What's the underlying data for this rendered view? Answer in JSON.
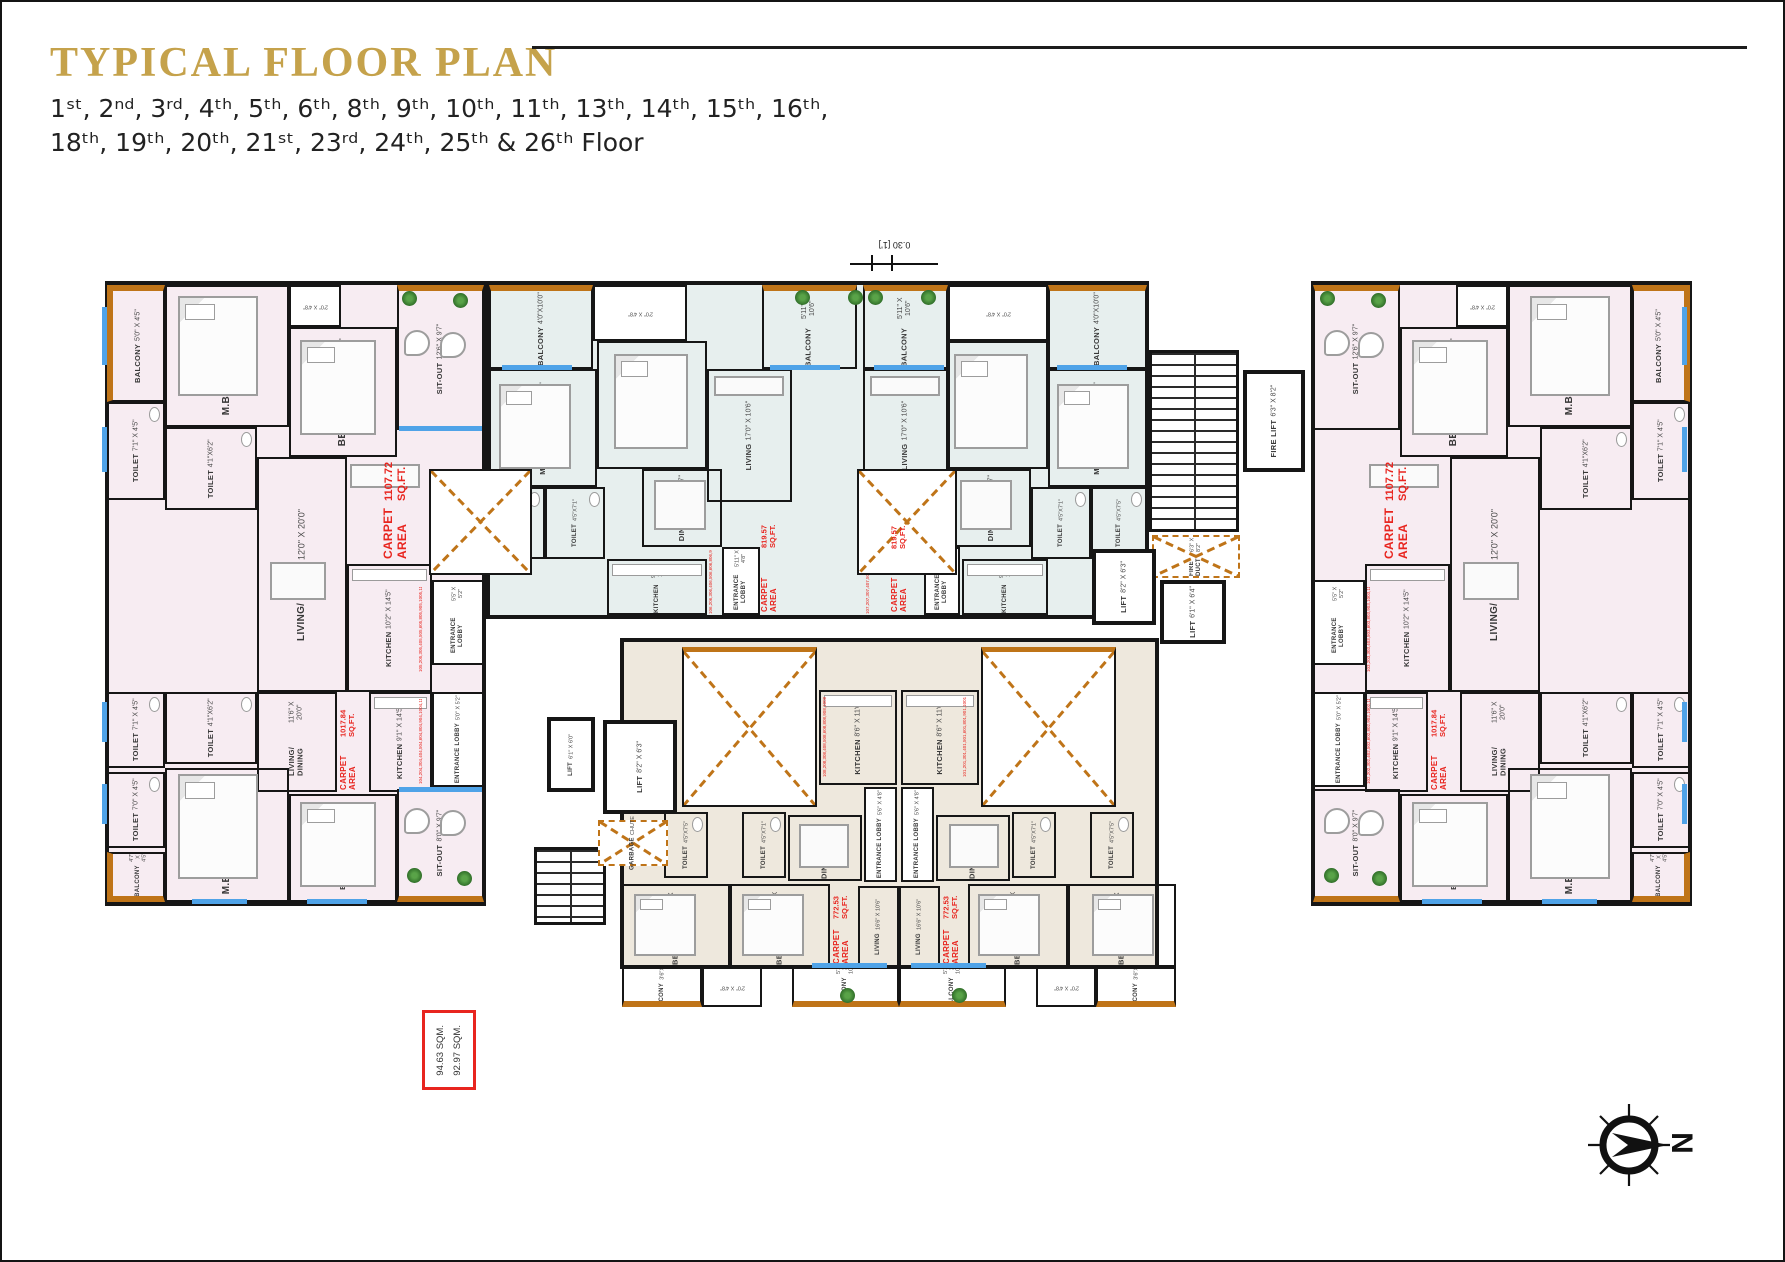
{
  "header": {
    "title": "TYPICAL FLOOR PLAN",
    "floors_line1": "1ˢᵗ, 2ⁿᵈ, 3ʳᵈ, 4ᵗʰ, 5ᵗʰ, 6ᵗʰ, 8ᵗʰ, 9ᵗʰ, 10ᵗʰ, 11ᵗʰ, 13ᵗʰ, 14ᵗʰ, 15ᵗʰ, 16ᵗʰ,",
    "floors_line2": "18ᵗʰ, 19ᵗʰ, 20ᵗʰ, 21ˢᵗ, 23ʳᵈ, 24ᵗʰ, 25ᵗʰ & 26ᵗʰ Floor"
  },
  "colors": {
    "gold": "#c5a24b",
    "carpet_red": "#e8251f",
    "balcony_orange": "#bf7418",
    "window_blue": "#4fa3e8",
    "wing_pink": "#f7ecf2",
    "center_teal": "#e7efee",
    "lower_tan": "#eee8dd"
  },
  "legend": {
    "area1": "94.63 SQM.",
    "area2": "92.97 SQM."
  },
  "compass": {
    "north": "N"
  },
  "dim_note": "0.30 [1']",
  "units": {
    "c1107": {
      "l1": "CARPET AREA",
      "l2": "1107.72 SQ.FT."
    },
    "c1017": {
      "l1": "CARPET AREA",
      "l2": "1017.84 SQ.FT."
    },
    "c819": {
      "l1": "CARPET AREA",
      "l2": "819.57 SQ.FT."
    },
    "c772": {
      "l1": "CARPET AREA",
      "l2": "772.53 SQ.FT."
    }
  },
  "flats": {
    "f05": "105,205,305,405,505,605,805,905,1005,1105,1305,1405,1505,1605,1805,1905,2005,2105,2305,2405,2505,2605",
    "f06": "106,206,306,406,506,606,806,906,1006,1106,1306,1406,1506,1606,1806,1906,2006,2106,2306,2406,2506,2606",
    "f07": "107,207,307,407,507,607,807,907,1007,1107,1307,1407,1507,1607,1807,1907,2007,2107,2307,2407,2507,2607",
    "f03": "103,203,303,403,503,603,803,903,1003,1103,1303,1403,1503,1603,1803,1903,2003,2103,2303,2403,2503,2603",
    "f04": "104,204,304,404,504,604,804,904,1004,1104,1304,1404,1504,1604,1804,1904,2004,2104,2304,2404,2504,2604",
    "f08": "108,208,308,408,508,608,808,908,1008,1108,1308,1408,1508,1608,1808,1908,2008,2108,2308,2408,2508,2608",
    "f01": "101,201,301,401,501,601,801,901,1001,1101,1301,1401,1501,1601,1801,1901,2001,2101,2301,2401,2501,2601",
    "f02": "102,202,302,402,502,602,802,902,1002,1102,1302,1402,1502,1602,1802,1902,2002,2102,2302,2402,2502,2602"
  },
  "rooms": {
    "balcony_5045": {
      "n": "BALCONY",
      "d": "5'0\" X 4'5\""
    },
    "toilet_7145": {
      "n": "TOILET",
      "d": "7'1\" X 4'5\""
    },
    "mbed_126110": {
      "n": "M.BEDROOM",
      "d": "12'6\" X 11'0\""
    },
    "duct_2048": {
      "d": "2'0\" X 4'8\""
    },
    "bed_106100": {
      "n": "BEDROOM",
      "d": "10'6\" X 10'0\""
    },
    "sitout_12697": {
      "n": "SIT-OUT",
      "d": "12'6\" X 9'7\""
    },
    "toilet_4162": {
      "n": "TOILET",
      "d": "4'1\"X6'2\""
    },
    "living_120200": {
      "n": "LIVING/ DINING",
      "d": "12'0\" X 20'0\""
    },
    "kitchen_102145": {
      "n": "KITCHEN",
      "d": "10'2\" X 14'5\""
    },
    "entrance_5552": {
      "n": "ENTRANCE LOBBY",
      "d": "5'5\" X 5'2\""
    },
    "toilet_7045": {
      "n": "TOILET",
      "d": "7'0\" X 4'5\""
    },
    "balcony_4745": {
      "n": "BALCONY",
      "d": "4'7\" X 4'5\""
    },
    "living_116200": {
      "n": "LIVING/ DINING",
      "d": "11'6\" X 20'0\""
    },
    "kitchen_91145": {
      "n": "KITCHEN",
      "d": "9'1\" X 14'5\""
    },
    "entrance_5052": {
      "n": "ENTRANCE LOBBY",
      "d": "5'0\" X 5'2\""
    },
    "mbed_120110": {
      "n": "M.BEDROOM",
      "d": "12'0\" X 11'0\""
    },
    "bed_100106": {
      "n": "BEDROOM",
      "d": "10'0\" X 10'6\""
    },
    "sitout_8097": {
      "n": "SIT-OUT",
      "d": "8'0\" X 9'7\""
    },
    "balcony_40100": {
      "n": "BALCONY",
      "d": "4'0\"X10'0\""
    },
    "mbed_121100": {
      "n": "M.BEDROOM",
      "d": "12'1\" X 10'0\""
    },
    "bed_110100": {
      "n": "BEDROOM",
      "d": "11'0\" X 10'0\""
    },
    "toilet_4575": {
      "n": "TOILET",
      "d": "4'5\"X7'5\""
    },
    "toilet_4571": {
      "n": "TOILET",
      "d": "4'5\"X7'1\""
    },
    "dining_91157": {
      "n": "DINING",
      "d": "9'11\" X 5'7\""
    },
    "living_170106": {
      "n": "LIVING",
      "d": "17'0\" X 10'6\""
    },
    "balcony_511106": {
      "n": "BALCONY",
      "d": "5'11\" X 10'6\""
    },
    "kitchen_90110": {
      "n": "KITCHEN",
      "d": "9'0\" X 11'0\""
    },
    "entrance_51148": {
      "n": "ENTRANCE LOBBY",
      "d": "5'11\" X 4'8\""
    },
    "kitchen_86110": {
      "n": "KITCHEN",
      "d": "8'6\" X 11'0\""
    },
    "entrance_5648": {
      "n": "ENTRANCE LOBBY",
      "d": "5'6\" X 4'8\""
    },
    "dining_9557": {
      "n": "DINING",
      "d": "9'5\" X 5'7\""
    },
    "living_166106": {
      "n": "LIVING",
      "d": "16'6\" X 10'6\""
    },
    "bed_116100": {
      "n": "BEDROOM",
      "d": "11'6\" X 10'0\""
    },
    "bed_100100": {
      "n": "BEDROOM",
      "d": "10'0\" X 10'0\""
    },
    "balcony_36100": {
      "n": "BALCONY",
      "d": "3'6\"X10'0\""
    },
    "lift_8263": {
      "n": "LIFT",
      "d": "8'2\" X 6'3\""
    },
    "lift_6164": {
      "n": "LIFT",
      "d": "6'1\" X 6'4\""
    },
    "lift_6160": {
      "n": "LIFT",
      "d": "6'1\" X 6'0\""
    },
    "firelift": {
      "n": "FIRE LIFT",
      "d": "6'3\" X 8'2\""
    },
    "fireduct": {
      "n": "FIRE DUCT",
      "d": "6'3\" X 8'2\""
    },
    "garbage": {
      "n": "GARBAGE",
      "d": "CHUTE"
    }
  }
}
